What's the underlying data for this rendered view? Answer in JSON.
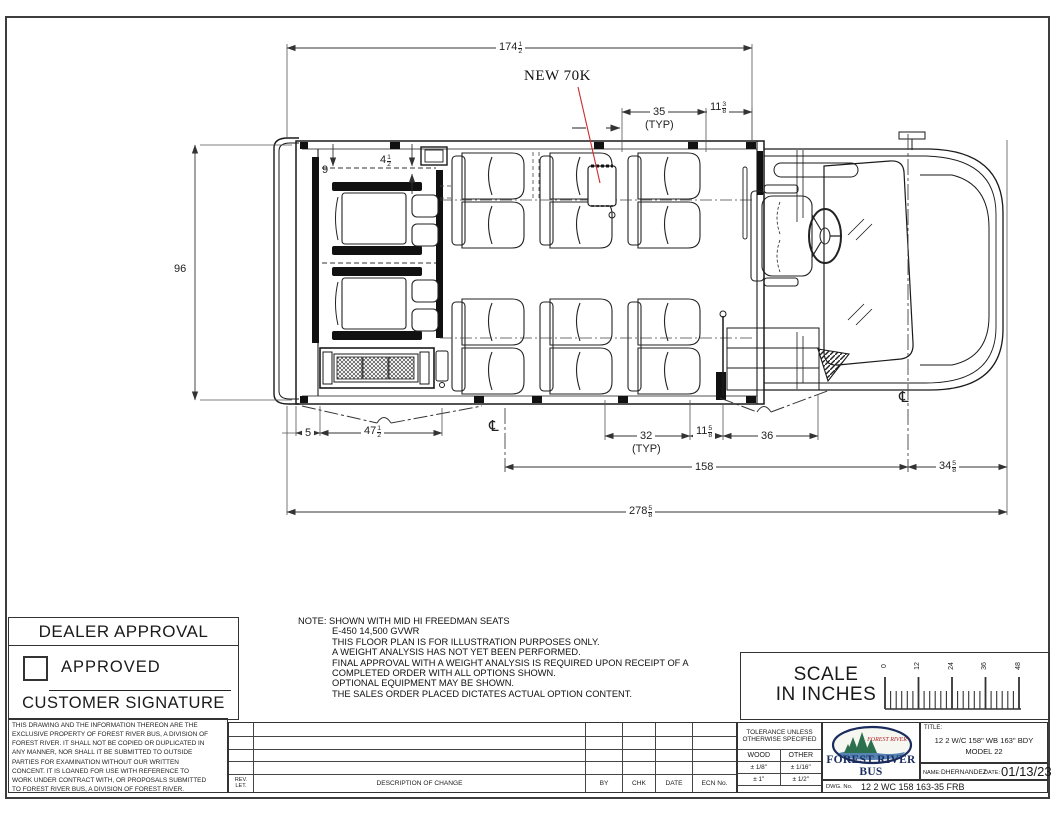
{
  "drawing": {
    "callout": "NEW 70K",
    "typ": "(TYP)",
    "cl": "℄",
    "d174": {
      "w": "174",
      "n": "1",
      "d": "2"
    },
    "d35": "35",
    "d11_38": {
      "w": "11",
      "n": "3",
      "d": "8"
    },
    "d96": "96",
    "d9": "9",
    "d4_12": {
      "w": "4",
      "n": "1",
      "d": "2"
    },
    "d5": "5",
    "d47_12": {
      "w": "47",
      "n": "1",
      "d": "2"
    },
    "d32": "32",
    "d11_58": {
      "w": "11",
      "n": "5",
      "d": "8"
    },
    "d36": "36",
    "d158": "158",
    "d34_58": {
      "w": "34",
      "n": "5",
      "d": "8"
    },
    "d278_58": {
      "w": "278",
      "n": "5",
      "d": "8"
    }
  },
  "dealer": {
    "title": "DEALER APPROVAL",
    "approved": "APPROVED",
    "signature": "CUSTOMER SIGNATURE"
  },
  "notes": {
    "label": "NOTE:",
    "lines": [
      "SHOWN WITH MID HI FREEDMAN SEATS",
      "E-450 14,500 GVWR",
      "THIS FLOOR PLAN IS  FOR ILLUSTRATION PURPOSES ONLY.",
      "A WEIGHT ANALYSIS HAS NOT YET BEEN PERFORMED.",
      "FINAL APPROVAL WITH A WEIGHT ANALYSIS IS REQUIRED UPON RECEIPT OF A",
      "COMPLETED ORDER WITH ALL OPTIONS SHOWN.",
      "OPTIONAL EQUIPMENT MAY BE SHOWN.",
      "THE SALES ORDER PLACED DICTATES ACTUAL OPTION CONTENT."
    ]
  },
  "scale": {
    "line1": "SCALE",
    "line2": "IN INCHES",
    "ticks": [
      "0",
      "12",
      "24",
      "36",
      "48"
    ]
  },
  "legal": {
    "lines": [
      "THIS DRAWING AND THE INFORMATION THEREON ARE THE",
      "EXCLUSIVE PROPERTY OF FOREST RIVER BUS, A DIVISION OF",
      "FOREST RIVER. IT SHALL NOT BE COPIED OR DUPLICATED IN",
      "ANY MANNER, NOR SHALL IT BE SUBMITTED TO OUTSIDE",
      "PARTIES FOR EXAMINATION WITHOUT OUR WRITTEN",
      "CONCENT. IT IS LOANED FOR USE WITH REFERENCE TO",
      "WORK UNDER CONTRACT WITH, OR PROPOSALS SUBMITTED",
      "TO FOREST RIVER BUS, A DIVISION OF FOREST RIVER."
    ]
  },
  "revision": {
    "rev": "REV.",
    "let": "LET.",
    "description": "DESCRIPTION OF CHANGE",
    "by": "BY",
    "chk": "CHK",
    "date": "DATE",
    "ecn": "ECN No."
  },
  "tolerance": {
    "line1": "TOLERANCE UNLESS",
    "line2": "OTHERWISE SPECIFIED",
    "col1": "WOOD",
    "col2": "OTHER",
    "rows": [
      {
        "wood": "± 1/8\"",
        "other": "± 1/16\""
      },
      {
        "wood": "± 1\"",
        "other": "± 1/2\""
      }
    ]
  },
  "title_block": {
    "logo_text": "FOREST RIVER",
    "brand": "FOREST RIVER BUS",
    "title_label": "TITLE:",
    "title_line1": "12 2 W/C 158\" WB 163\" BDY",
    "title_line2": "MODEL 22",
    "name_label": "NAME:",
    "name": "DHERNANDEZ",
    "date_label": "DATE:",
    "date": "01/13/23",
    "dwg_label": "DWG. No.",
    "dwg_no": "12 2 WC 158 163-35 FRB"
  },
  "colors": {
    "leader_red": "#cc2a2a",
    "brand_navy": "#1a2c5e",
    "tree_green": "#2d7050",
    "line_black": "#1a1a1a"
  }
}
